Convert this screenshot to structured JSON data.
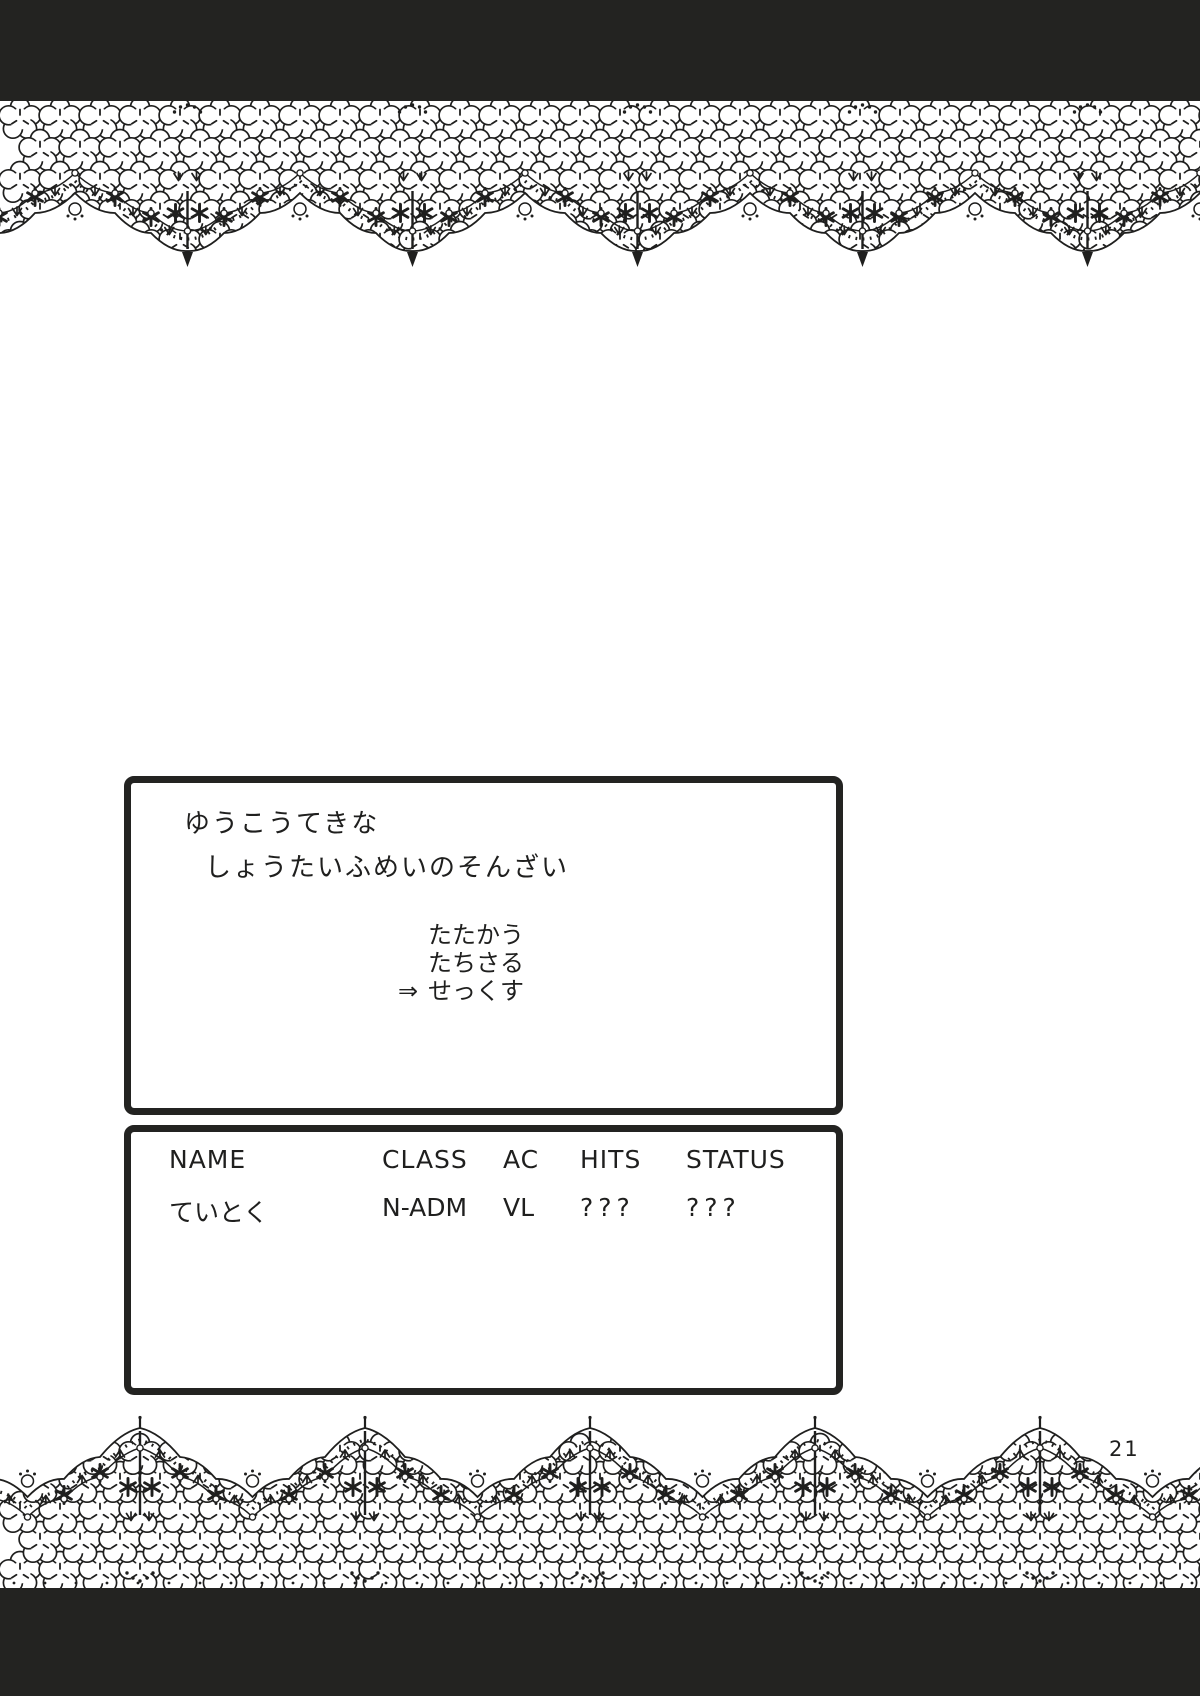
{
  "page": {
    "number": "21"
  },
  "colors": {
    "ink": "#1f1f1e",
    "paper": "#ffffff"
  },
  "battle_window": {
    "message_line1": "ゆうこうてきな",
    "message_line2": "しょうたいふめいのそんざい",
    "menu": {
      "cursor": "⇒",
      "selected_index": 2,
      "items": [
        {
          "label": "たたかう"
        },
        {
          "label": "たちさる"
        },
        {
          "label": "せっくす"
        }
      ]
    }
  },
  "status_window": {
    "headers": [
      "NAME",
      "CLASS",
      "AC",
      "HITS",
      "STATUS"
    ],
    "rows": [
      {
        "cells": [
          "ていとく",
          "N-ADM",
          "VL",
          "???",
          "???"
        ]
      }
    ]
  }
}
